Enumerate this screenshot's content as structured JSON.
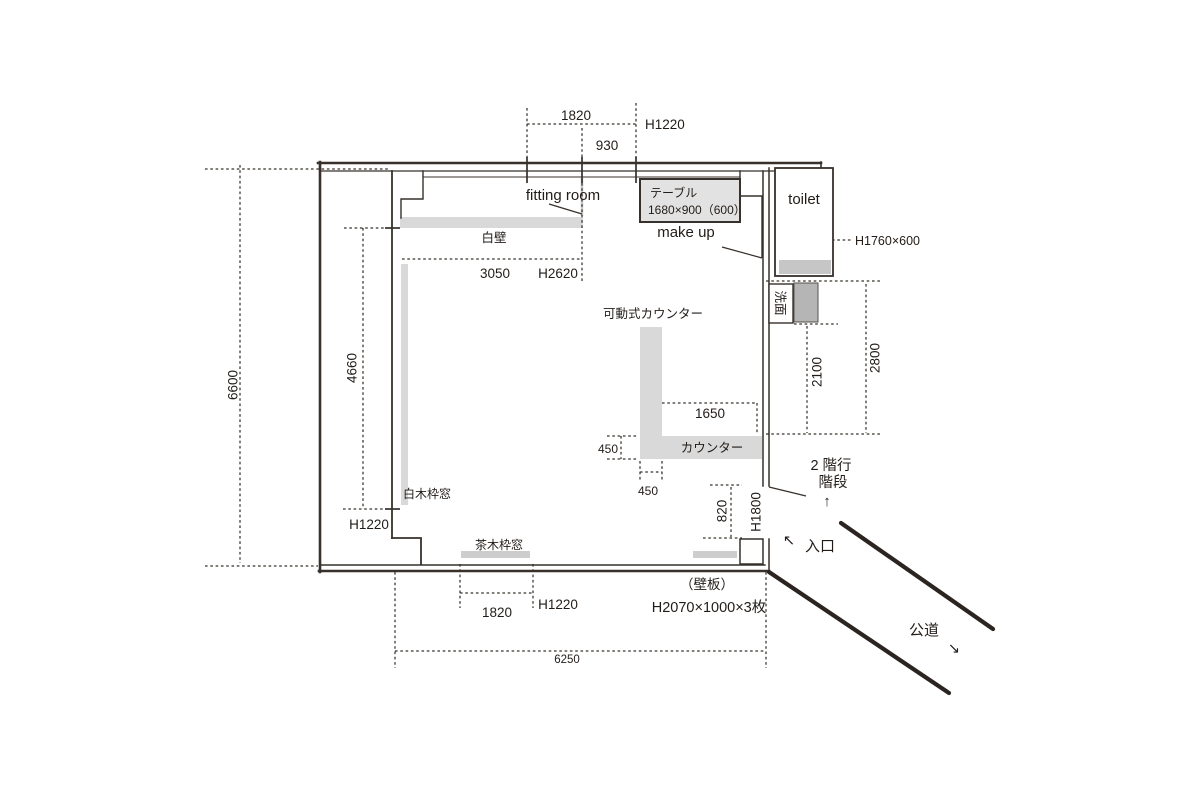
{
  "colors": {
    "line": "#37302b",
    "fill_light": "#d9d9d9",
    "fill_mid": "#c6c6c6",
    "fill_dark": "#b5b5b5"
  },
  "labels": {
    "fitting_room": "fitting room",
    "make_up": "make up",
    "toilet": "toilet",
    "table_name": "テーブル",
    "table_size": "1680×900（600）",
    "white_wall": "白壁",
    "movable_counter": "可動式カウンター",
    "counter": "カウンター",
    "washbasin": "洗面",
    "white_frame_window": "白木枠窓",
    "brown_frame_window": "茶木枠窓",
    "stairs_line1": "2 階行",
    "stairs_line2": "階段",
    "entrance": "入口",
    "public_road": "公道",
    "wall_board": "（壁板）",
    "wall_board_spec": "H2070×1000×3枚"
  },
  "dimensions": {
    "top_window_width": "1820",
    "top_offset": "930",
    "top_window_height": "H1220",
    "total_height": "6600",
    "left_inner_height": "4660",
    "left_window_height": "H1220",
    "white_wall_width": "3050",
    "white_wall_height": "H2620",
    "toilet_door": "H1760×600",
    "right_upper": "2100",
    "right_total": "2800",
    "counter_length": "1650",
    "counter_depth": "450",
    "counter_leg_width": "450",
    "entry_door_width": "820",
    "entry_door_height": "H1800",
    "bottom_window_width": "1820",
    "bottom_window_height": "H1220",
    "total_width": "6250"
  },
  "arrows": {
    "up": "↑",
    "up_left": "↖",
    "down_right": "↘"
  }
}
